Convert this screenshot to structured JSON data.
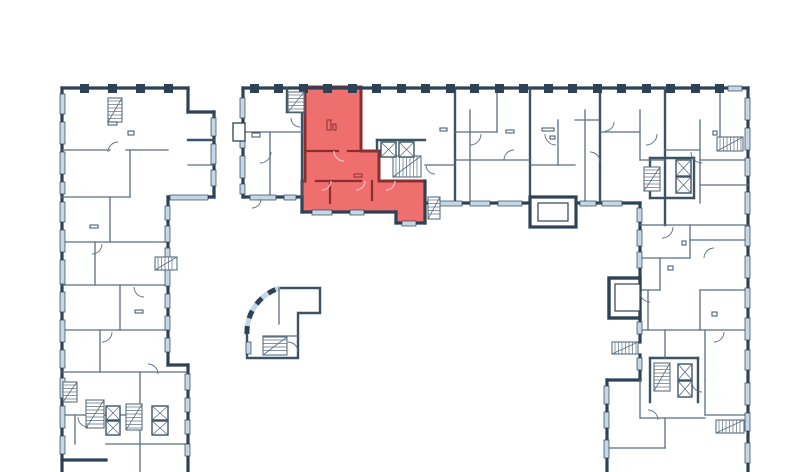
{
  "app": {
    "type": "floor-plan-viewer",
    "description": "Residential building floor plan with one highlighted apartment unit",
    "highlighted_unit_name": "selected-apartment"
  },
  "colors": {
    "background": "#ffffff",
    "wall": "#2d4255",
    "wall_medium": "#3c5265",
    "wall_thin": "#5b6e80",
    "window": "#c3d7e6",
    "unit_fill": "#ef6f6f",
    "unit_wall": "#8a2f2f",
    "unit_arc": "#f8c2c2",
    "paper": "#ffffff"
  },
  "canvas": {
    "width": 800,
    "height": 472
  },
  "plan": {
    "walls_thick": [
      [
        62,
        88,
        188,
        88
      ],
      [
        62,
        88,
        62,
        472
      ],
      [
        188,
        88,
        188,
        112
      ],
      [
        188,
        112,
        214,
        112
      ],
      [
        214,
        112,
        214,
        197
      ],
      [
        168,
        197,
        214,
        197
      ],
      [
        168,
        197,
        168,
        365
      ],
      [
        168,
        365,
        188,
        365
      ],
      [
        188,
        365,
        188,
        472
      ],
      [
        62,
        460,
        106,
        460
      ],
      [
        243,
        88,
        748,
        88
      ],
      [
        243,
        88,
        243,
        197
      ],
      [
        243,
        197,
        302,
        197
      ],
      [
        302,
        197,
        302,
        212
      ],
      [
        302,
        212,
        396,
        212
      ],
      [
        396,
        212,
        396,
        223
      ],
      [
        396,
        223,
        425,
        223
      ],
      [
        425,
        181,
        425,
        223
      ],
      [
        425,
        203,
        640,
        203
      ],
      [
        748,
        88,
        748,
        472
      ],
      [
        640,
        203,
        640,
        278
      ],
      [
        640,
        318,
        640,
        342
      ],
      [
        640,
        355,
        640,
        380
      ],
      [
        607,
        380,
        640,
        380
      ],
      [
        607,
        380,
        607,
        472
      ]
    ],
    "walls_medium": [
      [
        455,
        88,
        455,
        203
      ],
      [
        530,
        88,
        530,
        197
      ],
      [
        600,
        88,
        600,
        203
      ],
      [
        665,
        88,
        665,
        225
      ],
      [
        302,
        112,
        302,
        197
      ],
      [
        287,
        88,
        287,
        112
      ],
      [
        287,
        112,
        305,
        112
      ],
      [
        377,
        140,
        425,
        140
      ],
      [
        377,
        140,
        377,
        151
      ],
      [
        650,
        158,
        650,
        198
      ],
      [
        650,
        158,
        694,
        158
      ],
      [
        694,
        158,
        694,
        198
      ],
      [
        650,
        198,
        694,
        198
      ],
      [
        650,
        358,
        650,
        402
      ],
      [
        650,
        358,
        698,
        358
      ],
      [
        698,
        358,
        698,
        402
      ],
      [
        188,
        140,
        214,
        140
      ]
    ],
    "walls_thin": [
      [
        62,
        150,
        110,
        150
      ],
      [
        126,
        150,
        168,
        150
      ],
      [
        62,
        197,
        130,
        197
      ],
      [
        62,
        242,
        166,
        242
      ],
      [
        62,
        285,
        166,
        285
      ],
      [
        62,
        330,
        166,
        330
      ],
      [
        62,
        372,
        186,
        372
      ],
      [
        62,
        415,
        140,
        415
      ],
      [
        106,
        444,
        186,
        444
      ],
      [
        130,
        150,
        130,
        197
      ],
      [
        110,
        197,
        110,
        242
      ],
      [
        95,
        242,
        95,
        285
      ],
      [
        120,
        285,
        120,
        330
      ],
      [
        100,
        330,
        100,
        372
      ],
      [
        140,
        372,
        140,
        415
      ],
      [
        140,
        415,
        140,
        472
      ],
      [
        75,
        415,
        75,
        444
      ],
      [
        188,
        165,
        214,
        165
      ],
      [
        270,
        132,
        270,
        197
      ],
      [
        243,
        132,
        302,
        132
      ],
      [
        470,
        110,
        470,
        203
      ],
      [
        497,
        88,
        497,
        132
      ],
      [
        558,
        120,
        558,
        165
      ],
      [
        585,
        110,
        585,
        203
      ],
      [
        640,
        110,
        640,
        160
      ],
      [
        700,
        120,
        700,
        203
      ],
      [
        720,
        88,
        720,
        140
      ],
      [
        425,
        165,
        455,
        165
      ],
      [
        455,
        132,
        497,
        132
      ],
      [
        455,
        160,
        530,
        160
      ],
      [
        530,
        165,
        575,
        165
      ],
      [
        575,
        120,
        600,
        120
      ],
      [
        600,
        132,
        640,
        132
      ],
      [
        640,
        160,
        665,
        160
      ],
      [
        665,
        150,
        700,
        150
      ],
      [
        700,
        160,
        748,
        160
      ],
      [
        700,
        185,
        748,
        185
      ],
      [
        640,
        225,
        748,
        225
      ],
      [
        640,
        258,
        690,
        258
      ],
      [
        690,
        240,
        748,
        240
      ],
      [
        640,
        290,
        660,
        290
      ],
      [
        700,
        290,
        748,
        290
      ],
      [
        640,
        330,
        748,
        330
      ],
      [
        640,
        418,
        705,
        418
      ],
      [
        607,
        448,
        665,
        448
      ],
      [
        705,
        415,
        748,
        415
      ],
      [
        690,
        225,
        690,
        258
      ],
      [
        660,
        258,
        660,
        290
      ],
      [
        648,
        290,
        648,
        330
      ],
      [
        700,
        290,
        700,
        330
      ],
      [
        665,
        330,
        665,
        358
      ],
      [
        705,
        330,
        705,
        380
      ],
      [
        640,
        380,
        640,
        418
      ],
      [
        665,
        418,
        665,
        448
      ],
      [
        705,
        380,
        705,
        415
      ],
      [
        279,
        288,
        279,
        324
      ],
      [
        263,
        336,
        298,
        336
      ]
    ],
    "windows": [
      [
        240,
        98,
        5,
        20
      ],
      [
        240,
        126,
        5,
        22
      ],
      [
        240,
        156,
        5,
        22
      ],
      [
        240,
        184,
        5,
        10
      ],
      [
        250,
        195,
        26,
        5
      ],
      [
        284,
        195,
        12,
        5
      ],
      [
        440,
        201,
        22,
        5
      ],
      [
        470,
        201,
        20,
        5
      ],
      [
        498,
        201,
        24,
        5
      ],
      [
        580,
        201,
        16,
        5
      ],
      [
        602,
        201,
        20,
        5
      ],
      [
        728,
        86,
        14,
        5
      ],
      [
        60,
        94,
        5,
        20
      ],
      [
        60,
        122,
        5,
        22
      ],
      [
        60,
        152,
        5,
        22
      ],
      [
        60,
        182,
        5,
        12
      ],
      [
        60,
        202,
        5,
        20
      ],
      [
        60,
        230,
        5,
        22
      ],
      [
        60,
        260,
        5,
        24
      ],
      [
        60,
        292,
        5,
        20
      ],
      [
        60,
        320,
        5,
        22
      ],
      [
        60,
        350,
        5,
        18
      ],
      [
        60,
        378,
        5,
        20
      ],
      [
        60,
        406,
        5,
        22
      ],
      [
        60,
        436,
        5,
        18
      ],
      [
        211,
        118,
        5,
        18
      ],
      [
        211,
        144,
        5,
        20
      ],
      [
        211,
        170,
        5,
        16
      ],
      [
        170,
        195,
        38,
        5
      ],
      [
        165,
        206,
        5,
        14
      ],
      [
        165,
        226,
        5,
        16
      ],
      [
        165,
        248,
        5,
        14
      ],
      [
        165,
        270,
        5,
        16
      ],
      [
        165,
        294,
        5,
        14
      ],
      [
        165,
        316,
        5,
        14
      ],
      [
        165,
        338,
        5,
        14
      ],
      [
        185,
        374,
        5,
        16
      ],
      [
        185,
        398,
        5,
        14
      ],
      [
        185,
        420,
        5,
        14
      ],
      [
        185,
        444,
        5,
        12
      ],
      [
        745,
        98,
        5,
        22
      ],
      [
        745,
        128,
        5,
        22
      ],
      [
        745,
        158,
        5,
        18
      ],
      [
        745,
        192,
        5,
        22
      ],
      [
        745,
        226,
        5,
        20
      ],
      [
        745,
        256,
        5,
        22
      ],
      [
        745,
        288,
        5,
        20
      ],
      [
        745,
        318,
        5,
        22
      ],
      [
        745,
        350,
        5,
        20
      ],
      [
        745,
        383,
        5,
        22
      ],
      [
        745,
        413,
        5,
        18
      ],
      [
        745,
        443,
        5,
        20
      ],
      [
        637,
        208,
        5,
        14
      ],
      [
        637,
        230,
        5,
        16
      ],
      [
        637,
        252,
        5,
        16
      ],
      [
        637,
        322,
        5,
        12
      ],
      [
        637,
        358,
        5,
        12
      ],
      [
        604,
        386,
        5,
        18
      ],
      [
        604,
        412,
        5,
        16
      ],
      [
        604,
        440,
        5,
        18
      ],
      [
        246,
        342,
        5,
        12
      ]
    ],
    "piers": [
      80,
      108,
      136,
      164,
      250,
      274,
      299,
      323,
      348,
      372,
      397,
      421,
      446,
      470,
      495,
      519,
      544,
      568,
      593,
      617,
      642,
      666,
      691,
      715
    ],
    "stairs": [
      [
        288,
        92,
        16,
        20,
        "v"
      ],
      [
        393,
        156,
        28,
        21,
        "h"
      ],
      [
        428,
        197,
        12,
        22,
        "v"
      ],
      [
        717,
        137,
        26,
        14,
        "h"
      ],
      [
        644,
        167,
        16,
        24,
        "v"
      ],
      [
        654,
        363,
        16,
        28,
        "v"
      ],
      [
        612,
        342,
        26,
        12,
        "h"
      ],
      [
        716,
        420,
        28,
        13,
        "h"
      ],
      [
        155,
        257,
        22,
        13,
        "h"
      ],
      [
        86,
        400,
        18,
        28,
        "v"
      ],
      [
        63,
        382,
        14,
        20,
        "v"
      ],
      [
        263,
        337,
        24,
        18,
        "v"
      ],
      [
        108,
        98,
        14,
        24,
        "v"
      ],
      [
        126,
        404,
        16,
        26,
        "v"
      ]
    ],
    "elevators": [
      [
        381,
        142,
        15,
        15
      ],
      [
        399,
        142,
        15,
        15
      ],
      [
        676,
        160,
        15,
        16
      ],
      [
        676,
        177,
        15,
        16
      ],
      [
        678,
        364,
        14,
        16
      ],
      [
        678,
        381,
        14,
        16
      ],
      [
        106,
        406,
        14,
        14
      ],
      [
        106,
        421,
        14,
        14
      ],
      [
        152,
        406,
        16,
        14
      ],
      [
        152,
        421,
        16,
        14
      ]
    ],
    "door_arcs": [
      [
        260,
        152,
        11,
        0
      ],
      [
        300,
        118,
        9,
        90
      ],
      [
        470,
        134,
        11,
        0
      ],
      [
        514,
        160,
        10,
        180
      ],
      [
        556,
        134,
        11,
        90
      ],
      [
        590,
        162,
        10,
        270
      ],
      [
        646,
        134,
        11,
        0
      ],
      [
        702,
        152,
        11,
        90
      ],
      [
        662,
        227,
        11,
        0
      ],
      [
        714,
        258,
        10,
        180
      ],
      [
        650,
        292,
        10,
        90
      ],
      [
        714,
        332,
        10,
        0
      ],
      [
        648,
        420,
        10,
        270
      ],
      [
        702,
        382,
        10,
        90
      ],
      [
        118,
        152,
        10,
        180
      ],
      [
        92,
        244,
        10,
        0
      ],
      [
        144,
        287,
        10,
        90
      ],
      [
        102,
        332,
        10,
        0
      ],
      [
        148,
        374,
        10,
        270
      ],
      [
        88,
        417,
        10,
        90
      ],
      [
        288,
        352,
        10,
        270
      ],
      [
        252,
        199,
        9,
        0
      ],
      [
        435,
        165,
        9,
        90
      ],
      [
        605,
        122,
        9,
        0
      ]
    ],
    "fixtures": [
      [
        108,
        122,
        9,
        3
      ],
      [
        128,
        131,
        6,
        4
      ],
      [
        252,
        133,
        8,
        4
      ],
      [
        440,
        128,
        7,
        3
      ],
      [
        506,
        130,
        8,
        3
      ],
      [
        542,
        128,
        12,
        3
      ],
      [
        550,
        136,
        5,
        3
      ],
      [
        713,
        131,
        4,
        4
      ],
      [
        668,
        266,
        5,
        4
      ],
      [
        712,
        312,
        5,
        4
      ],
      [
        682,
        241,
        4,
        4
      ],
      [
        90,
        225,
        8,
        3
      ],
      [
        135,
        310,
        8,
        3
      ]
    ],
    "boxes": [
      {
        "x": 233,
        "y": 123,
        "w": 12,
        "h": 18,
        "s": 1.3,
        "name": "bay-window-box"
      },
      {
        "x": 609,
        "y": 278,
        "w": 31,
        "h": 40,
        "s": 3.4,
        "name": "balcony-box"
      },
      {
        "x": 615,
        "y": 284,
        "w": 25,
        "h": 27,
        "s": 1.2,
        "name": "balcony-box-inner"
      },
      {
        "x": 530,
        "y": 197,
        "w": 46,
        "h": 30,
        "s": 3.2,
        "name": "entrance-vestibule"
      },
      {
        "x": 538,
        "y": 203,
        "w": 30,
        "h": 18,
        "s": 1.2,
        "name": "entrance-vestibule-inner"
      }
    ],
    "pavilion": {
      "outline": "M280 288 L320 288 L320 313 L298 313 L298 358 L247 358 L247 334 A46 46 0 0 1 280 288 Z",
      "glazing": "M247 334 A46 46 0 0 1 280 288"
    },
    "unit": {
      "path": "M305 87 L361 87 L361 151 L379 151 L379 181 L425 181 L425 223 L396 223 L396 212 L302 212 L302 181 L305 181 Z",
      "walls": [
        [
          305,
          151,
          338,
          151
        ],
        [
          348,
          151,
          361,
          151
        ],
        [
          316,
          181,
          361,
          181
        ],
        [
          330,
          181,
          330,
          203
        ],
        [
          372,
          181,
          372,
          200
        ]
      ],
      "windows": [
        [
          312,
          210,
          20,
          5
        ],
        [
          350,
          210,
          14,
          5
        ],
        [
          402,
          221,
          14,
          5
        ]
      ],
      "arcs": [
        [
          344,
          151,
          10,
          90
        ],
        [
          322,
          181,
          9,
          0
        ],
        [
          356,
          181,
          9,
          0
        ],
        [
          386,
          181,
          9,
          0
        ]
      ],
      "fixtures": [
        [
          327,
          120,
          4,
          10
        ],
        [
          333,
          124,
          3,
          6
        ],
        [
          354,
          174,
          8,
          3
        ]
      ]
    }
  }
}
